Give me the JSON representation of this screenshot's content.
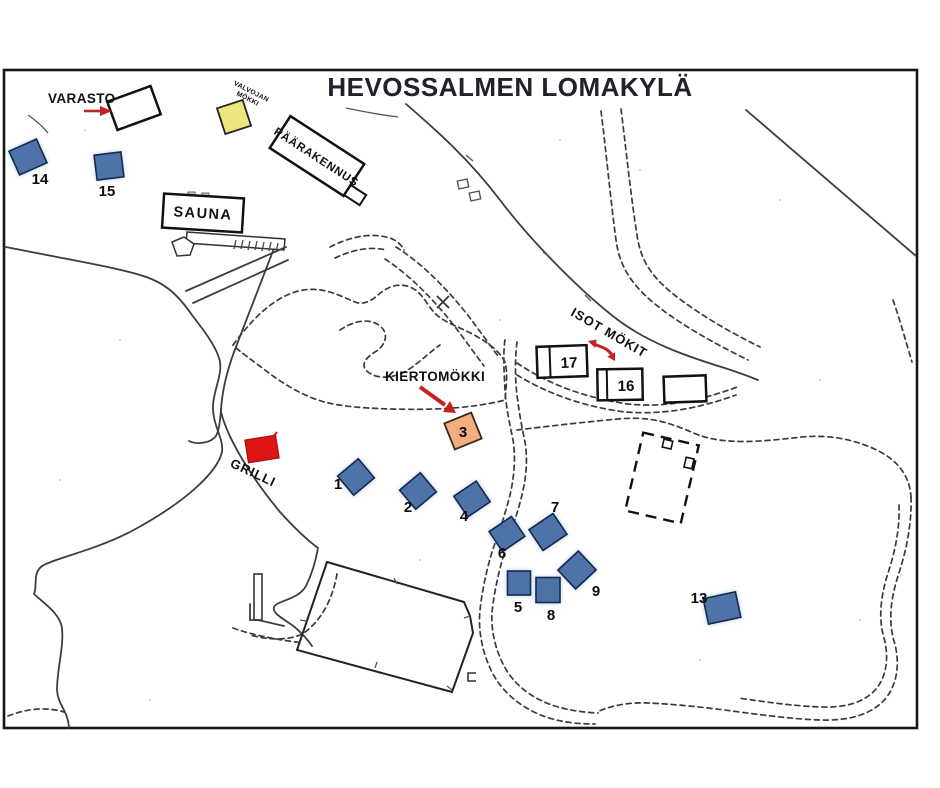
{
  "map": {
    "title": "HEVOSSALMEN LOMAKYLÄ",
    "labels": {
      "varasto": "VARASTO",
      "valvojan_line1": "VALVOJAN",
      "valvojan_line2": "MÖKKI",
      "paarakennus": "PÄÄRAKENNUS",
      "sauna": "SAUNA",
      "kiertomokki": "KIERTOMÖKKI",
      "isot_mokit": "ISOT MÖKIT",
      "grilli": "GRILLI"
    },
    "cabins": [
      {
        "number": "1"
      },
      {
        "number": "2"
      },
      {
        "number": "3"
      },
      {
        "number": "4"
      },
      {
        "number": "5"
      },
      {
        "number": "6"
      },
      {
        "number": "7"
      },
      {
        "number": "8"
      },
      {
        "number": "9"
      },
      {
        "number": "13"
      },
      {
        "number": "14"
      },
      {
        "number": "15"
      },
      {
        "number": "16"
      },
      {
        "number": "17"
      }
    ],
    "colors": {
      "cabin_blue": "#4e73a8",
      "warden_yellow": "#ece77c",
      "kiertomokki_orange": "#f2ad80",
      "grill_red": "#de1512",
      "arrow_red": "#c42220",
      "map_line": "#3d3d3d",
      "ink": "#101014"
    }
  }
}
